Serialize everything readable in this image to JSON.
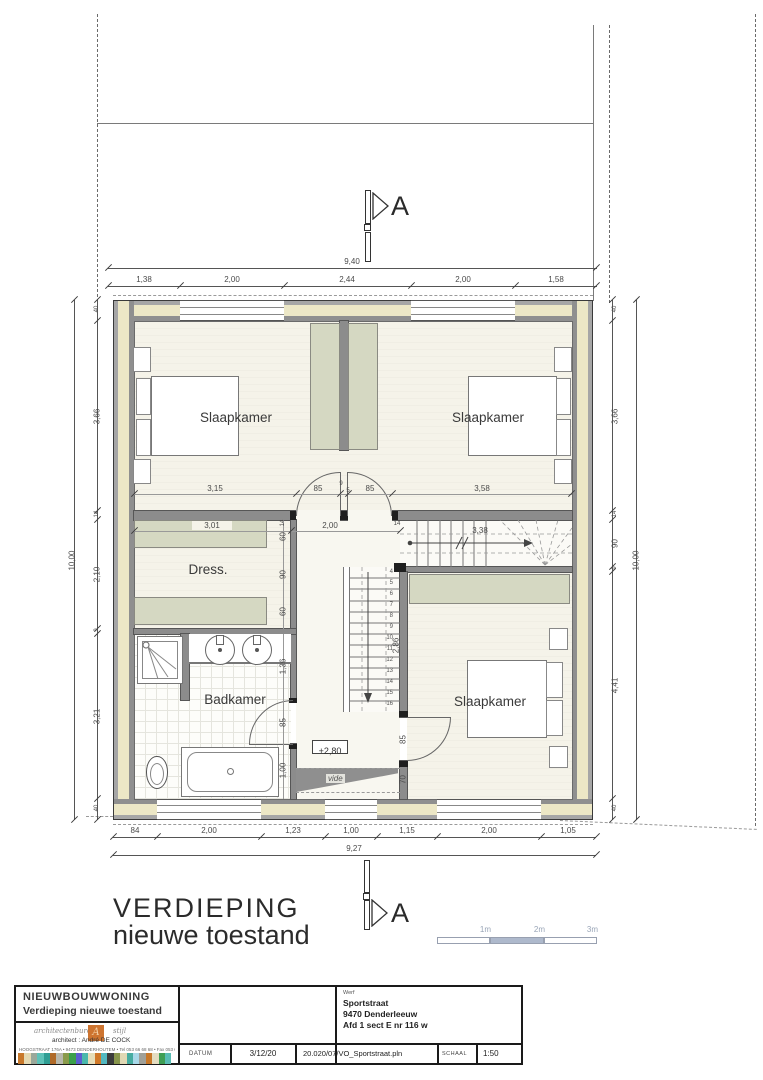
{
  "drawing": {
    "title_line1": "VERDIEPING",
    "title_line2": "nieuwe toestand",
    "section_label": "A",
    "rooms": {
      "bedroom1": "Slaapkamer",
      "bedroom2": "Slaapkamer",
      "bedroom3": "Slaapkamer",
      "dressing": "Dress.",
      "bathroom": "Badkamer",
      "void_label": "vide",
      "level_label": "+2,80"
    },
    "dims": {
      "top_total": "9,40",
      "top_row": [
        "1,38",
        "2,00",
        "2,44",
        "2,00",
        "1,58"
      ],
      "bottom_row": [
        "84",
        "2,00",
        "1,23",
        "1,00",
        "1,15",
        "2,00",
        "1,05"
      ],
      "bottom_total": "9,27",
      "left_col": [
        "40",
        "3,66",
        "14",
        "2,10",
        "9",
        "3,21",
        "40"
      ],
      "left_total": "10,00",
      "right_col": [
        "40",
        "3,66",
        "14",
        "90",
        "9",
        "4,41",
        "40"
      ],
      "right_total": "10,00",
      "bedroom_row": [
        "3,15",
        "85",
        "9",
        "5",
        "85",
        "3,58"
      ],
      "dress_width": "3,01",
      "hall_width": "2,00",
      "hall_wall": "14",
      "dress_col": [
        "14",
        "60",
        "90",
        "60"
      ],
      "stair_upper": "3,38",
      "stair_well": "2,86",
      "bath_col": [
        "1,36",
        "85",
        "1,00"
      ],
      "bed3_col": [
        "85",
        "70"
      ],
      "stair_numbers": [
        "4",
        "5",
        "6",
        "7",
        "8",
        "9",
        "10",
        "11",
        "12",
        "13",
        "14",
        "15",
        "16"
      ]
    },
    "scale_bar": {
      "labels": [
        "1m",
        "2m",
        "3m"
      ]
    }
  },
  "title_block": {
    "project": "NIEUWBOUWWONING",
    "subtitle": "Verdieping nieuwe toestand",
    "bureau_script": "architectenbureau",
    "bureau_script2": "stijl",
    "architect_line": "architect : André DE COCK",
    "address_line": "HOOGSTRAAT 176A  •  9473 DENDERHOUTEM  •  Tel 053 66 68 68  •  Fax 053 67 24 17",
    "werf_label": "Werf",
    "werf_lines": [
      "Sportstraat",
      "9470 Denderleeuw",
      "Afd 1 sect E nr 116 w"
    ],
    "datum_label": "DATUM",
    "datum_value": "3/12/20",
    "file_ref": "20.020/07/VO_Sportstraat.pln",
    "schaal_label": "SCHAAL",
    "schaal_value": "1:50"
  },
  "colors": {
    "wall_insulation": "#ece7c6",
    "wall_leaf": "#8f8f8f",
    "closet_fill": "#d5d8c2",
    "floor": "#f5f3e9",
    "scale_fill": "#aeb9cc",
    "logo_orange": "#cd7430",
    "mosaic": [
      "#c8782a",
      "#e4d9b2",
      "#9aa89a",
      "#5ec2b8",
      "#2f9e94",
      "#b06a28",
      "#b8b8ac",
      "#8a9a4a",
      "#3aa04a",
      "#5a5ece",
      "#49b8ac",
      "#e6ddb8",
      "#d07828",
      "#52b8c0",
      "#3c3c3c",
      "#88964c",
      "#e0d8b4",
      "#46aca0",
      "#a8d8e8",
      "#a0a098",
      "#c87828",
      "#e4dcc0",
      "#3f9e54",
      "#58bcb4"
    ]
  }
}
